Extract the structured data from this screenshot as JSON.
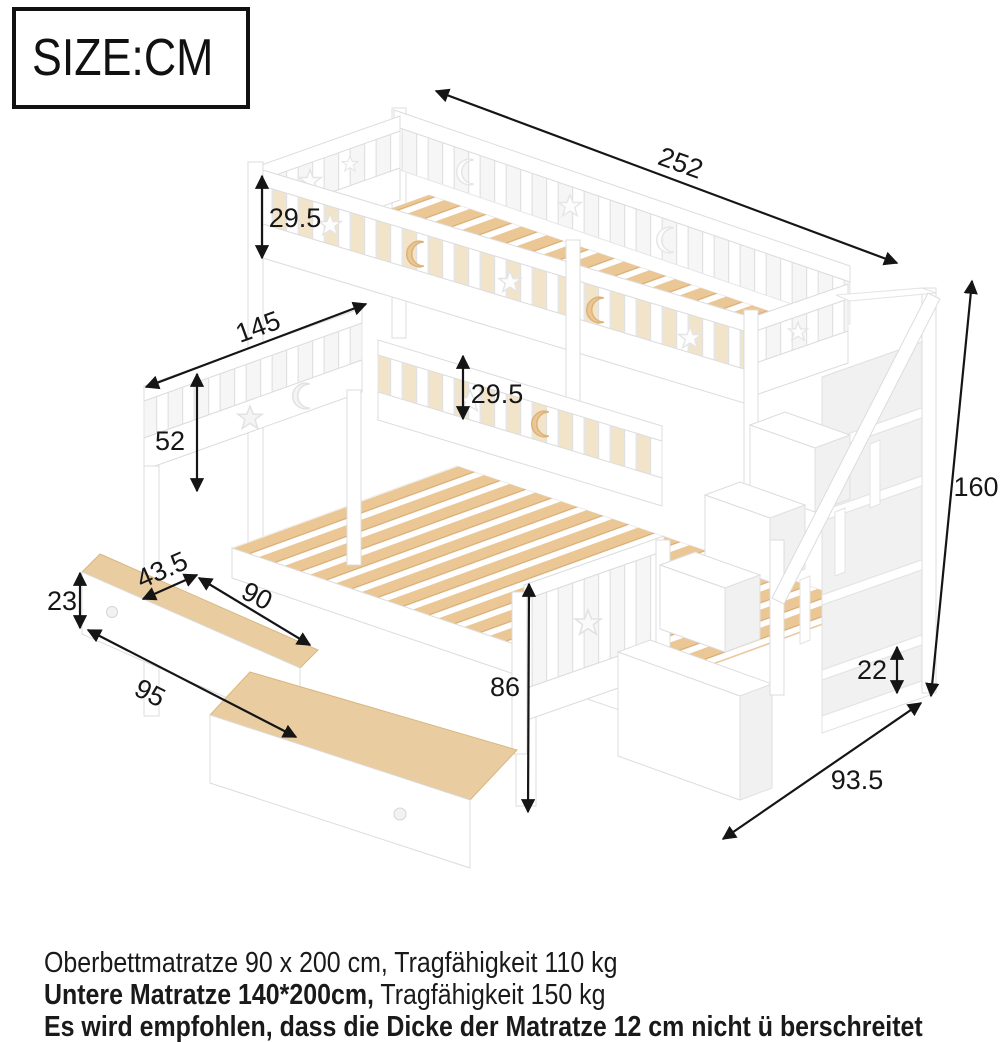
{
  "size_box": {
    "label": "SIZE:CM"
  },
  "dimensions": {
    "total_length": "252",
    "upper_rail_height": "29.5",
    "lower_bed_width": "145",
    "headboard_height": "52",
    "lower_rail_height": "29.5",
    "total_height": "160",
    "drawer_inner_width": "43.5",
    "drawer_inner_length": "90",
    "drawer_front_height": "23",
    "drawer_front_width": "95",
    "under_bed_height": "86",
    "shelf_opening_height": "22",
    "stair_depth": "93.5"
  },
  "notes": {
    "line1": "Oberbettmatratze 90 x 200 cm, Tragfähigkeit 110 kg",
    "line2_bold": "Untere Matratze 140*200cm,",
    "line2_rest": " Tragfähigkeit 150 kg",
    "line3": "Es wird empfohlen, dass die Dicke der Matratze 12 cm nicht  ü berschreitet"
  },
  "colors": {
    "wood": "#eac795",
    "wood_edge": "#d9ab72",
    "outline": "#dcdcdc",
    "arrow": "#151515",
    "text": "#1a1a1a"
  }
}
